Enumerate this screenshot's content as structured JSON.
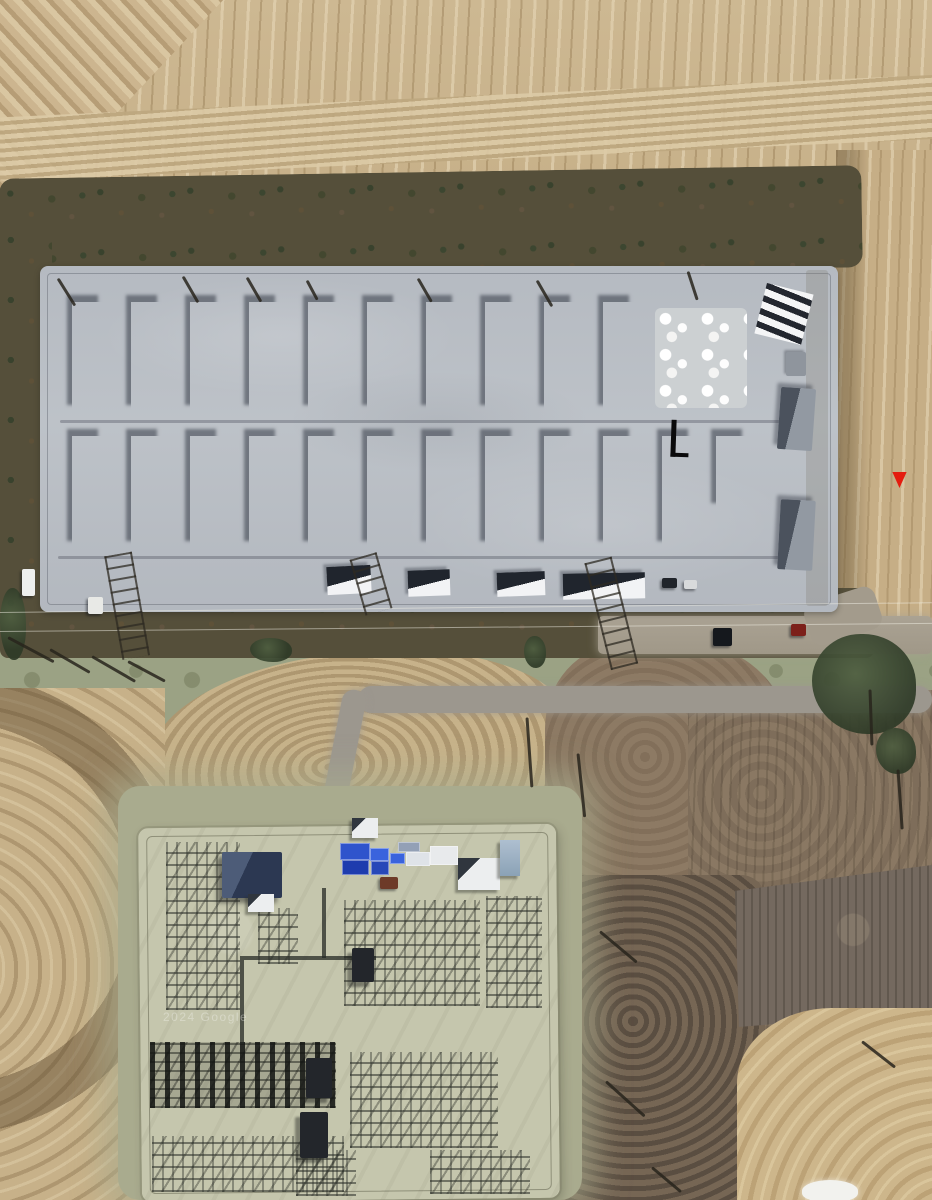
{
  "meta": {
    "view": "satellite aerial view",
    "scene": "container storage yard under construction with electrical substation, farm fields around",
    "watermark": "2024 Google"
  },
  "palette": {
    "field_tan": "#c9b28b",
    "field_gold": "#cdb68b",
    "vegetation_dark": "#554f3a",
    "pad_concrete": "#b8bdc4",
    "building_white": "#eef0f2",
    "roof_dark": "#272c35",
    "blue_crate": "#2f54cc",
    "substation_gravel": "#c5c6ad",
    "road_gray": "#9c978e",
    "grass": "#9ba284",
    "dirt_brown": "#8d7a64",
    "marker_red": "#e41c0f"
  },
  "marker": {
    "x": 891,
    "y": 472,
    "w": 17,
    "h": 16,
    "color": "#e41c0f",
    "shape": "triangle-down"
  },
  "annotation_mark": {
    "x": 671,
    "y": 420,
    "shape": "L",
    "color": "#0a0a0b"
  },
  "storage_yard": {
    "building_w": 31,
    "rows": [
      {
        "y": 302,
        "h": 110,
        "cols": [
          {
            "x": 72
          },
          {
            "x": 131
          },
          {
            "x": 190
          },
          {
            "x": 249
          },
          {
            "x": 308
          },
          {
            "x": 367
          },
          {
            "x": 426
          },
          {
            "x": 485
          },
          {
            "x": 544
          },
          {
            "x": 603
          }
        ]
      },
      {
        "y": 436,
        "h": 112,
        "cols": [
          {
            "x": 72
          },
          {
            "x": 131,
            "v": "blue"
          },
          {
            "x": 190
          },
          {
            "x": 249,
            "v": "blue"
          },
          {
            "x": 308
          },
          {
            "x": 367
          },
          {
            "x": 426
          },
          {
            "x": 485
          },
          {
            "x": 544
          },
          {
            "x": 603
          },
          {
            "x": 662
          },
          {
            "x": 716,
            "h": 74,
            "v": "short"
          }
        ]
      }
    ],
    "construction_patch": {
      "x": 655,
      "y": 308,
      "w": 92,
      "h": 100
    },
    "flat_buildings": [
      {
        "x": 327,
        "y": 566,
        "w": 44,
        "h": 28,
        "r": -3
      },
      {
        "x": 408,
        "y": 570,
        "w": 42,
        "h": 26,
        "r": -2
      },
      {
        "x": 497,
        "y": 572,
        "w": 48,
        "h": 24,
        "r": -2
      },
      {
        "x": 563,
        "y": 573,
        "w": 82,
        "h": 26,
        "r": -1
      }
    ],
    "dark_buildings": [
      {
        "x": 779,
        "y": 388,
        "w": 35,
        "h": 62,
        "r": 4
      },
      {
        "x": 779,
        "y": 500,
        "w": 35,
        "h": 70,
        "r": 3
      }
    ],
    "striped_building": {
      "x": 760,
      "y": 288,
      "w": 48,
      "h": 52,
      "r": 14
    },
    "gray_unit": {
      "x": 786,
      "y": 352,
      "w": 20,
      "h": 24
    },
    "tire_lines": [
      {
        "x": 58,
        "y": 556,
        "w": 744
      },
      {
        "x": 60,
        "y": 420,
        "w": 730
      }
    ]
  },
  "substation": {
    "control_building": {
      "x": 222,
      "y": 852,
      "w": 60,
      "h": 46
    },
    "sheds": [
      {
        "x": 248,
        "y": 894,
        "w": 26,
        "h": 18,
        "type": "white-shed"
      },
      {
        "x": 458,
        "y": 858,
        "w": 42,
        "h": 32,
        "type": "white-shed"
      },
      {
        "x": 352,
        "y": 818,
        "w": 26,
        "h": 20,
        "type": "white-shed"
      },
      {
        "x": 500,
        "y": 840,
        "w": 20,
        "h": 36,
        "type": "blue-container"
      }
    ],
    "crates": [
      {
        "x": 340,
        "y": 843,
        "w": 28,
        "h": 15,
        "c": "#2f54cc"
      },
      {
        "x": 342,
        "y": 860,
        "w": 25,
        "h": 13,
        "c": "#1e3cae"
      },
      {
        "x": 370,
        "y": 848,
        "w": 17,
        "h": 11,
        "c": "#3a63dd"
      },
      {
        "x": 371,
        "y": 861,
        "w": 16,
        "h": 12,
        "c": "#2748b8"
      },
      {
        "x": 390,
        "y": 853,
        "w": 13,
        "h": 9,
        "c": "#3a63dd"
      },
      {
        "x": 398,
        "y": 842,
        "w": 20,
        "h": 8,
        "c": "#93a0b6"
      },
      {
        "x": 406,
        "y": 852,
        "w": 22,
        "h": 12,
        "c": "#dfe3e8"
      },
      {
        "x": 430,
        "y": 846,
        "w": 26,
        "h": 17,
        "c": "#e8eaec"
      }
    ],
    "yard_vehicle": {
      "x": 380,
      "y": 877,
      "w": 18,
      "h": 12,
      "c": "#6d3a28"
    },
    "lattices": [
      {
        "x": 166,
        "y": 842,
        "w": 74,
        "h": 168,
        "v": "rows"
      },
      {
        "x": 258,
        "y": 908,
        "w": 40,
        "h": 56,
        "v": "rows"
      },
      {
        "x": 344,
        "y": 900,
        "w": 136,
        "h": 106,
        "v": "rows"
      },
      {
        "x": 486,
        "y": 896,
        "w": 56,
        "h": 112,
        "v": "rows"
      },
      {
        "x": 150,
        "y": 1042,
        "w": 186,
        "h": 66,
        "v": "dense"
      },
      {
        "x": 152,
        "y": 1136,
        "w": 192,
        "h": 56,
        "v": "rows"
      },
      {
        "x": 350,
        "y": 1052,
        "w": 148,
        "h": 96,
        "v": "rows"
      },
      {
        "x": 430,
        "y": 1150,
        "w": 100,
        "h": 44,
        "v": "rows"
      },
      {
        "x": 296,
        "y": 1150,
        "w": 60,
        "h": 46,
        "v": "rows"
      }
    ],
    "transformers": [
      {
        "x": 306,
        "y": 1058,
        "w": 26,
        "h": 40
      },
      {
        "x": 300,
        "y": 1112,
        "w": 28,
        "h": 46
      },
      {
        "x": 352,
        "y": 948,
        "w": 22,
        "h": 34
      }
    ],
    "bus_lines": [
      {
        "x": 240,
        "y": 956,
        "w": 136,
        "h": 4
      },
      {
        "x": 322,
        "y": 888,
        "w": 4,
        "h": 70
      },
      {
        "x": 240,
        "y": 960,
        "w": 4,
        "h": 84
      }
    ]
  },
  "vehicles": [
    {
      "x": 22,
      "y": 569,
      "w": 13,
      "h": 27,
      "c": "#edefee"
    },
    {
      "x": 88,
      "y": 597,
      "w": 15,
      "h": 17,
      "c": "#e8e9e6"
    },
    {
      "x": 662,
      "y": 578,
      "w": 15,
      "h": 10,
      "c": "#20242a"
    },
    {
      "x": 684,
      "y": 580,
      "w": 13,
      "h": 9,
      "c": "#d8dadb"
    },
    {
      "x": 713,
      "y": 628,
      "w": 19,
      "h": 18,
      "c": "#15181d"
    },
    {
      "x": 791,
      "y": 624,
      "w": 15,
      "h": 12,
      "c": "#7c201a"
    }
  ],
  "poles": [
    {
      "x": 58,
      "y": 277,
      "len": 32,
      "rot": 58
    },
    {
      "x": 183,
      "y": 275,
      "len": 30,
      "rot": 60
    },
    {
      "x": 247,
      "y": 276,
      "len": 28,
      "rot": 60
    },
    {
      "x": 307,
      "y": 279,
      "len": 22,
      "rot": 62
    },
    {
      "x": 418,
      "y": 277,
      "len": 27,
      "rot": 60
    },
    {
      "x": 537,
      "y": 279,
      "len": 30,
      "rot": 60
    },
    {
      "x": 688,
      "y": 270,
      "len": 30,
      "rot": 72
    },
    {
      "x": 8,
      "y": 636,
      "len": 52,
      "rot": 28
    },
    {
      "x": 50,
      "y": 648,
      "len": 46,
      "rot": 30
    },
    {
      "x": 92,
      "y": 655,
      "len": 50,
      "rot": 30
    },
    {
      "x": 128,
      "y": 660,
      "len": 42,
      "rot": 28
    },
    {
      "x": 527,
      "y": 716,
      "len": 70,
      "rot": 86
    },
    {
      "x": 578,
      "y": 752,
      "len": 64,
      "rot": 84
    },
    {
      "x": 600,
      "y": 930,
      "len": 48,
      "rot": 40
    },
    {
      "x": 606,
      "y": 1080,
      "len": 52,
      "rot": 42
    },
    {
      "x": 652,
      "y": 1166,
      "len": 38,
      "rot": 40
    },
    {
      "x": 870,
      "y": 688,
      "len": 56,
      "rot": 88
    },
    {
      "x": 898,
      "y": 768,
      "len": 60,
      "rot": 86
    },
    {
      "x": 862,
      "y": 1040,
      "len": 42,
      "rot": 38
    }
  ],
  "ladders": [
    {
      "x": 118,
      "y": 540,
      "len": 105,
      "rot": 80
    },
    {
      "x": 363,
      "y": 542,
      "len": 58,
      "rot": 74
    },
    {
      "x": 598,
      "y": 546,
      "len": 110,
      "rot": 76
    }
  ],
  "wires": [
    {
      "x": 0,
      "y": 612,
      "w": 932,
      "rot": -0.6
    },
    {
      "x": 0,
      "y": 631,
      "w": 932,
      "rot": -0.5
    }
  ],
  "trees": [
    {
      "x": 0,
      "y": 588,
      "w": 26,
      "h": 72
    },
    {
      "x": 250,
      "y": 638,
      "w": 42,
      "h": 24
    },
    {
      "x": 524,
      "y": 636,
      "w": 22,
      "h": 32
    },
    {
      "x": 812,
      "y": 634,
      "w": 104,
      "h": 100
    },
    {
      "x": 876,
      "y": 728,
      "w": 40,
      "h": 46
    }
  ],
  "white_blob": {
    "x": 802,
    "y": 1180,
    "w": 56,
    "h": 22
  }
}
